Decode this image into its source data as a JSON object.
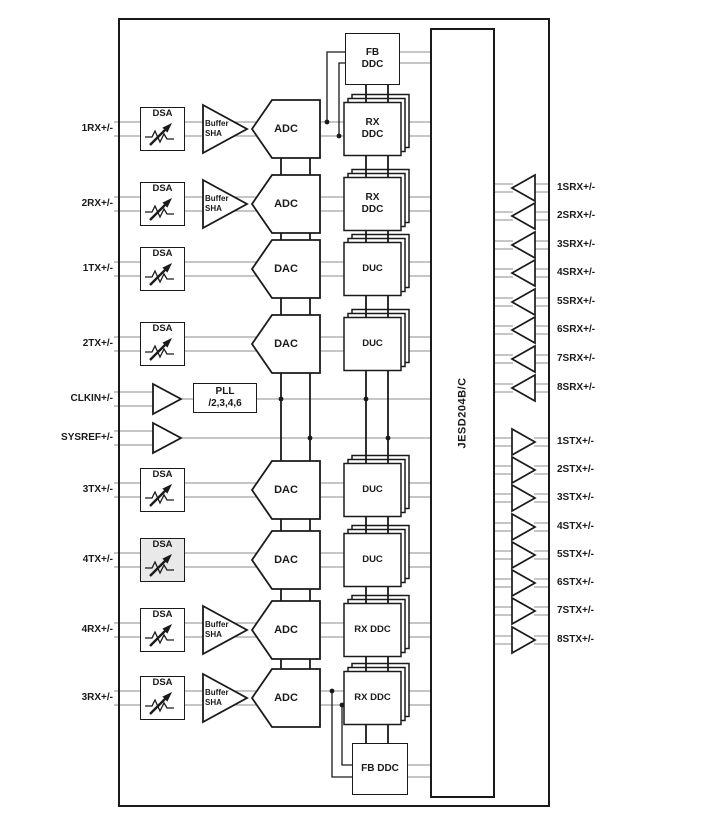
{
  "chip": {
    "jesd_label": "JESD204B/C"
  },
  "pll": {
    "line1": "PLL",
    "line2": "/2,3,4,6"
  },
  "blocks": {
    "dsa": "DSA",
    "buffer_line1": "Buffer",
    "buffer_line2": "SHA",
    "adc": "ADC",
    "dac": "DAC",
    "duc": "DUC",
    "rx_ddc_line1": "RX",
    "rx_ddc_line2": "DDC",
    "rx_ddc": "RX DDC",
    "fb_ddc_line1": "FB",
    "fb_ddc_line2": "DDC",
    "fb_ddc": "FB DDC"
  },
  "left_labels": [
    "1RX+/-",
    "2RX+/-",
    "1TX+/-",
    "2TX+/-",
    "CLKIN+/-",
    "SYSREF+/-",
    "3TX+/-",
    "4TX+/-",
    "4RX+/-",
    "3RX+/-"
  ],
  "srx_labels": [
    "1SRX+/-",
    "2SRX+/-",
    "3SRX+/-",
    "4SRX+/-",
    "5SRX+/-",
    "6SRX+/-",
    "7SRX+/-",
    "8SRX+/-"
  ],
  "stx_labels": [
    "1STX+/-",
    "2STX+/-",
    "3STX+/-",
    "4STX+/-",
    "5STX+/-",
    "6STX+/-",
    "7STX+/-",
    "8STX+/-"
  ],
  "colors": {
    "ink": "#1a1a1a",
    "rail": "#8c8c8c",
    "dsa_alt_fill": "#e9e9e9"
  }
}
